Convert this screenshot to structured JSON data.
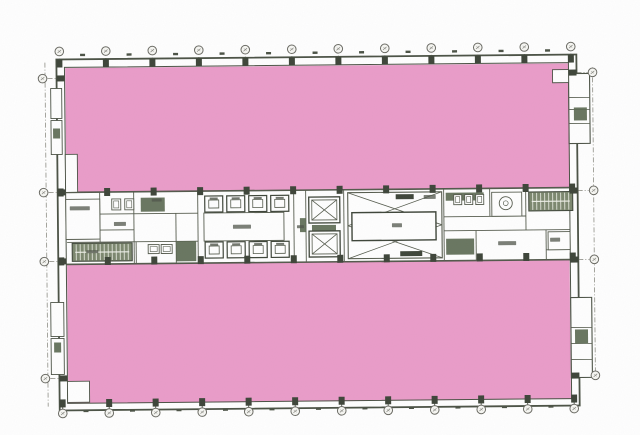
{
  "image": {
    "kind": "scanned-architectural-floor-plan",
    "visible_text": []
  },
  "colors": {
    "paper": "#ffffff",
    "highlight_pink": "#ea9cc9",
    "highlight_edge": "#d783b4",
    "line": "#4b5245",
    "wall_dark": "#3e4539",
    "partition": "#565c4e",
    "hatch_green": "#5c6a52",
    "stair_fill": "#7c886f",
    "stair_tread": "#eef0e8",
    "label_smudge": "#4f544a",
    "bubble_stroke": "#6b6b64",
    "dash_line": "#8e8e85"
  },
  "plan": {
    "rotation_deg": -0.55,
    "cx": 318,
    "cy": 229,
    "pink_areas": [
      {
        "name": "upper-tenant-area",
        "rect": [
          67,
          66,
          503,
          124
        ]
      },
      {
        "name": "lower-tenant-area",
        "rect": [
          67,
          262,
          502,
          139
        ]
      }
    ],
    "outer_wall": {
      "outer": [
        58,
        57,
        520,
        351
      ],
      "inner": [
        66,
        65,
        504,
        336
      ]
    },
    "core_band": {
      "top_y": 190,
      "bottom_y": 262,
      "x1": 66,
      "x2": 570
    },
    "grid": {
      "top_row": {
        "y": 49,
        "stub": [
          56,
          64
        ],
        "xs": [
          61,
          107.5,
          154,
          200.5,
          247,
          293.5,
          340,
          386.5,
          433,
          479.5,
          526,
          572.5
        ]
      },
      "bottom_row": {
        "y": 411,
        "stub": [
          401,
          407
        ],
        "xs": [
          61,
          107.5,
          154,
          200.5,
          247,
          293.5,
          340,
          386.5,
          433,
          479.5,
          526,
          572.5
        ]
      },
      "left_col": {
        "x": 44,
        "stub": [
          49,
          60
        ],
        "ys": [
          76,
          190,
          259,
          376
        ]
      },
      "right_col": {
        "x": 594,
        "stub": [
          578,
          589
        ],
        "ys": [
          75,
          193,
          262,
          378
        ]
      },
      "bubble_radius": 4.3,
      "vertical_dash_lines": [
        {
          "x": 46.5,
          "y1": 60,
          "y2": 404
        },
        {
          "x": 594,
          "y1": 70,
          "y2": 382
        }
      ]
    },
    "column_rows_y": [
      57,
      186,
      255,
      397
    ],
    "column_size": [
      6,
      8
    ],
    "window_tick_rows_y": [
      51.5,
      407.5
    ],
    "wall_side_columns": {
      "left_x": 58,
      "right_x": 570,
      "w": 8,
      "h": 6
    },
    "partition_lines": [
      [
        66,
        190,
        570,
        190
      ],
      [
        66,
        262,
        570,
        262
      ],
      [
        100,
        190,
        100,
        240
      ],
      [
        100,
        212,
        198,
        212
      ],
      [
        100,
        228,
        134,
        228
      ],
      [
        134,
        190,
        134,
        262
      ],
      [
        176,
        212,
        176,
        262
      ],
      [
        198,
        190,
        198,
        262
      ],
      [
        294,
        190,
        294,
        262
      ],
      [
        306,
        190,
        306,
        262
      ],
      [
        344,
        190,
        344,
        262
      ],
      [
        444,
        190,
        444,
        262
      ],
      [
        490,
        190,
        490,
        218
      ],
      [
        526,
        190,
        526,
        232
      ],
      [
        444,
        218,
        526,
        218
      ],
      [
        444,
        232,
        570,
        232
      ],
      [
        476,
        232,
        476,
        262
      ],
      [
        546,
        232,
        546,
        262
      ],
      [
        546,
        252,
        570,
        252
      ],
      [
        67,
        240,
        198,
        240
      ],
      [
        136,
        240,
        136,
        262
      ],
      [
        66,
        237,
        100,
        237
      ]
    ],
    "rooms": [
      {
        "name": "machine-room-left",
        "rect": [
          66,
          197,
          34,
          40
        ]
      },
      {
        "name": "elevator-lobby",
        "rect": [
          204,
          212,
          80,
          28
        ]
      },
      {
        "name": "wc-booth-room",
        "rect": [
          492,
          194,
          30,
          24
        ]
      },
      {
        "name": "storage-room-right",
        "rect": [
          548,
          234,
          22,
          18
        ]
      }
    ],
    "paper_notches": [
      {
        "name": "corner-room-top-right",
        "rect": [
          554,
          72,
          16,
          13
        ]
      },
      {
        "name": "corner-room-bottom-left",
        "rect": [
          66,
          379,
          22,
          21
        ]
      },
      {
        "name": "left-wall-recess",
        "rect": [
          66,
          152,
          12,
          38
        ]
      }
    ],
    "side_strips": [
      {
        "name": "right-service-strip-upper",
        "rect": [
          570,
          76,
          21,
          70
        ],
        "dividers_y": [
          100,
          112,
          126
        ]
      },
      {
        "name": "right-service-strip-lower",
        "rect": [
          570,
          300,
          21,
          80
        ],
        "dividers_y": [
          330,
          346,
          362
        ]
      }
    ],
    "side_boxes": [
      [
        52,
        86,
        11,
        30
      ],
      [
        52,
        118,
        11,
        34
      ],
      [
        50,
        300,
        13,
        34
      ],
      [
        50,
        336,
        13,
        36
      ]
    ],
    "hatch_blocks": [
      [
        141,
        196,
        24,
        14
      ],
      [
        176,
        240,
        20,
        20
      ],
      [
        312,
        225,
        24,
        7
      ],
      [
        446,
        194,
        38,
        8
      ],
      [
        446,
        240,
        28,
        16
      ],
      [
        300,
        218,
        6,
        14
      ],
      [
        575,
        110,
        13,
        13
      ],
      [
        574,
        332,
        13,
        14
      ],
      [
        54,
        126,
        7,
        10
      ],
      [
        53,
        340,
        7,
        10
      ]
    ],
    "elevators": {
      "xs": [
        205,
        227,
        249,
        271
      ],
      "rows_y": [
        195,
        241
      ],
      "car_w": 18,
      "car_h": 16
    },
    "shafts": [
      {
        "name": "service-shaft-upper",
        "rect": [
          309,
          197,
          31,
          26
        ]
      },
      {
        "name": "service-shaft-lower",
        "rect": [
          309,
          231,
          31,
          26
        ]
      }
    ],
    "big_room": {
      "name": "central-hall",
      "outer": [
        348,
        193,
        94,
        66
      ],
      "inner": [
        352,
        213,
        84,
        28
      ],
      "vents": [
        [
          396,
          195,
          18,
          5
        ],
        [
          400,
          252,
          22,
          5
        ]
      ]
    },
    "stairs": [
      {
        "name": "stair-west",
        "rect": [
          72,
          241,
          60,
          18
        ],
        "step": 4
      },
      {
        "name": "stair-east",
        "rect": [
          529,
          194,
          44,
          19
        ],
        "step": 4
      }
    ],
    "fixtures": [
      [
        112,
        197,
        9,
        11
      ],
      [
        125,
        197,
        9,
        11
      ],
      [
        148,
        243,
        11,
        9
      ],
      [
        161,
        243,
        11,
        9
      ],
      [
        454,
        196,
        8,
        10
      ],
      [
        465,
        196,
        8,
        10
      ],
      [
        476,
        196,
        8,
        10
      ]
    ],
    "round_fixture": {
      "cx": 506,
      "cy": 205,
      "r": 6.5
    },
    "label_smudges": [
      [
        70,
        204,
        20,
        4
      ],
      [
        114,
        220,
        12,
        4
      ],
      [
        233,
        224,
        18,
        4
      ],
      [
        392,
        224,
        10,
        4
      ],
      [
        297,
        225,
        7,
        3
      ],
      [
        498,
        243,
        18,
        4
      ],
      [
        550,
        240,
        10,
        4
      ],
      [
        424,
        196,
        12,
        4
      ],
      [
        152,
        197,
        10,
        3
      ],
      [
        86,
        248,
        12,
        3
      ]
    ]
  }
}
